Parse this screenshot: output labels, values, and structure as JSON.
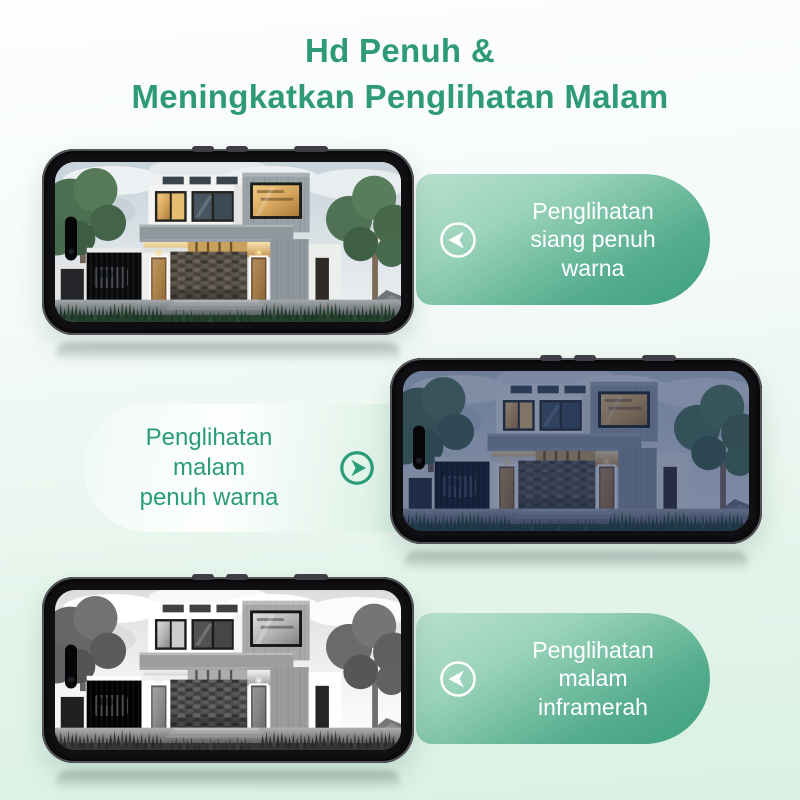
{
  "title": {
    "line1": "Hd Penuh &",
    "line2": "Meningkatkan Penglihatan Malam"
  },
  "sections": [
    {
      "id": "day-full-color",
      "label_lines": [
        "Penglihatan",
        "siang penuh",
        "warna"
      ],
      "icon": "arrow-left-circle-icon",
      "phone_view": "full-color daytime house scene"
    },
    {
      "id": "night-full-color",
      "label_lines": [
        "Penglihatan",
        "malam",
        "penuh warna"
      ],
      "icon": "arrow-right-circle-icon",
      "phone_view": "full-color night house scene"
    },
    {
      "id": "night-infrared",
      "label_lines": [
        "Penglihatan",
        "malam",
        "inframerah"
      ],
      "icon": "arrow-left-circle-icon",
      "phone_view": "black-and-white infrared house scene"
    }
  ],
  "colors": {
    "title_green": "#2e9b76",
    "badge_gradient_light": "#b4ddca",
    "badge_gradient_dark": "#3fa07f",
    "badge_text_white": "#ffffff",
    "light_badge_bg_start": "#f4fbf7",
    "light_badge_bg_end": "#d6eee1",
    "light_badge_text_green": "#2a9c77",
    "page_bg_top": "#fbfefd",
    "page_bg_bottom": "#d9f1e5"
  }
}
